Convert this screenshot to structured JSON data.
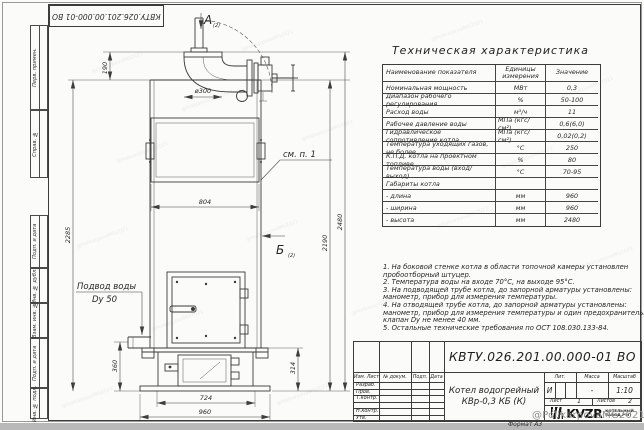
{
  "page": {
    "doc_number": "КВТУ.026.201.00.000-01 ВО",
    "format_label": "Формат А3",
    "watermark": "@PolikarpovaMG2021"
  },
  "frame": {
    "left_labels": [
      "Перв. примен.",
      "Справ. №",
      "Подп. и дата",
      "Инв. № дубл.",
      "Взам. инв. №",
      "Подп. и дата",
      "Инв. № подл."
    ]
  },
  "tech_table": {
    "title": "Техническая характеристика",
    "col_name": "Наименование показателя",
    "col_units": "Единицы измерения",
    "col_value": "Значение",
    "rows": [
      [
        "Номинальная мощность",
        "МВт",
        "0,3"
      ],
      [
        "Диапазон рабочего регулирования",
        "%",
        "50-100"
      ],
      [
        "Расход воды",
        "м³/ч",
        "11"
      ],
      [
        "Рабочее давление воды",
        "МПа (кгс/см²)",
        "0,6(6,0)"
      ],
      [
        "Гидравлическое сопротивление котла",
        "МПа (кгс/см²)",
        "0,02(0,2)"
      ],
      [
        "Температура уходящих газов, не более",
        "°С",
        "250"
      ],
      [
        "К.П.Д. котла на проектном топливе",
        "%",
        "80"
      ],
      [
        "Температура воды (вход/выход)",
        "°С",
        "70-95"
      ],
      [
        "Габариты котла",
        "",
        ""
      ],
      [
        "- длина",
        "мм",
        "960"
      ],
      [
        "- ширина",
        "мм",
        "960"
      ],
      [
        "- высота",
        "мм",
        "2480"
      ]
    ]
  },
  "notes": [
    "1. На боковой стенке котла в области топочной камеры установлен",
    "пробоотборный штуцер.",
    "2. Температура воды на входе 70°С, на выходе 95°С.",
    "3. На подводящей трубе котла, до запорной арматуры установлены:",
    "манометр, прибор для измерения температуры.",
    "4. На отводящей трубе котла, до запорной арматуры установлены:",
    "манометр, прибор для измерения температуры и один предохранительный",
    "клапан Dу не менее 40 мм.",
    "5. Остальные технические требования по ОСТ 108.030.133-84."
  ],
  "title_block": {
    "doc_number": "КВТУ.026.201.00.000-01 ВО",
    "product_line1": "Котел водогрейный",
    "product_line2": "КВр-0,3 КБ (К)",
    "col_headers": [
      "Изм. Лист",
      "№ докум.",
      "Подп.",
      "Дата"
    ],
    "row_labels": [
      "Разраб.",
      "Пров.",
      "Т.контр.",
      "",
      "Н.контр.",
      "Утв."
    ],
    "lit_label": "Лит.",
    "mass_label": "Масса",
    "scale_label": "Масштаб",
    "lit_value": "И",
    "mass_value": "-",
    "scale_value": "1:10",
    "sheet_label": "Лист",
    "sheet_value": "1",
    "sheets_label": "Листов",
    "sheets_value": "2",
    "logo_name": "KVZR",
    "logo_caption1": "КОТЕЛЬНЫЙ",
    "logo_caption2": "ЗАВОД РЭП"
  },
  "drawing": {
    "view_a": "А",
    "view_a_sub": "(2)",
    "view_b": "Б",
    "view_b_sub": "(2)",
    "see_note_label": "см. п. 1",
    "water_inlet_line1": "Подвод воды",
    "water_inlet_line2": "Dy 50",
    "dims": {
      "chimney_height": "190",
      "chimney_dia": "ø300",
      "body_height_left": "2285",
      "body_width": "804",
      "height_right": "2190",
      "total_height": "2480",
      "inlet_height": "360",
      "ash_height": "314",
      "base_width": "724",
      "total_width": "960"
    }
  }
}
